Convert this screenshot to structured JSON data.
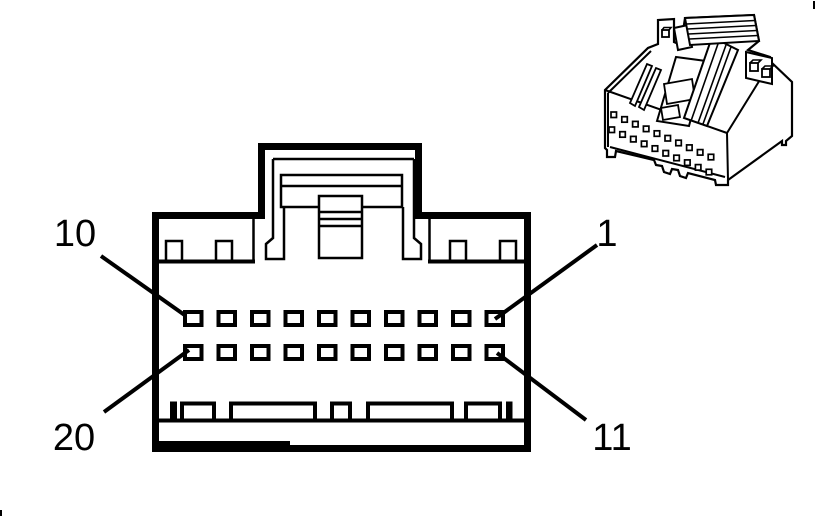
{
  "colors": {
    "ink": "#000000",
    "paper": "#ffffff"
  },
  "front_view": {
    "rows": 2,
    "pins_per_row": 10,
    "callouts": [
      {
        "position": "top-left",
        "label": "10"
      },
      {
        "position": "top-right",
        "label": "1"
      },
      {
        "position": "bottom-left",
        "label": "20"
      },
      {
        "position": "bottom-right",
        "label": "11"
      }
    ]
  },
  "iso_view": {
    "rows": 2,
    "holes_per_row": 10
  }
}
